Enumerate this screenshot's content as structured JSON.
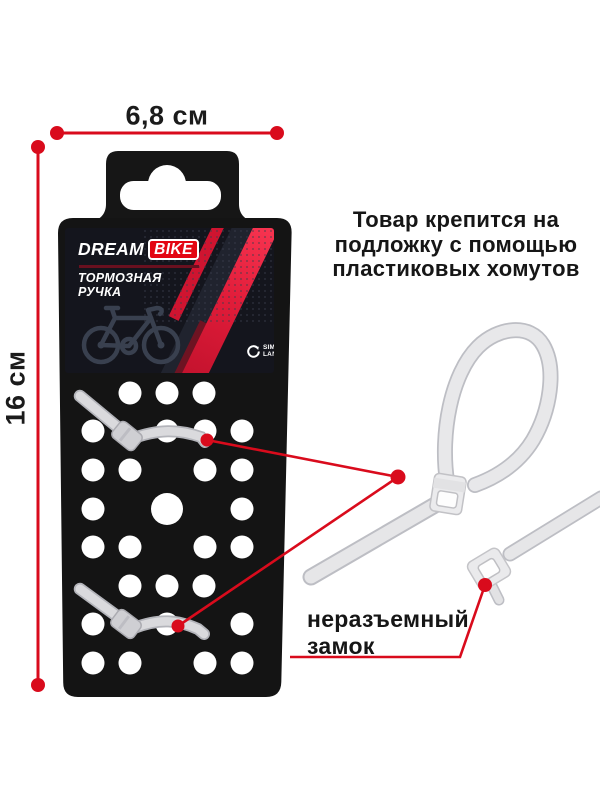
{
  "dimensions": {
    "width_label": "6,8 см",
    "height_label": "16 см"
  },
  "note": {
    "lines": [
      "Товар крепится на",
      "подложку с помощью",
      "пластиковых хомутов"
    ]
  },
  "lock_label": {
    "lines": [
      "неразъемный",
      "замок"
    ]
  },
  "card": {
    "brand_dream": "DREAM",
    "brand_bike": "BIKE",
    "product_lines": [
      "ТОРМОЗНАЯ",
      "РУЧКА"
    ],
    "vendor": {
      "line1": "SIMA",
      "line2": "LAND"
    }
  },
  "icons": {
    "bicycle": "bicycle-outline-icon",
    "vendor_mark": "simaland-swirl-icon"
  },
  "colors": {
    "annotation_red": "#d90b1c",
    "badge_red": "#e30613",
    "package_black": "#151515",
    "card_bg": "#14151d",
    "tie_gray": "#e3e3e6",
    "background": "#ffffff"
  }
}
